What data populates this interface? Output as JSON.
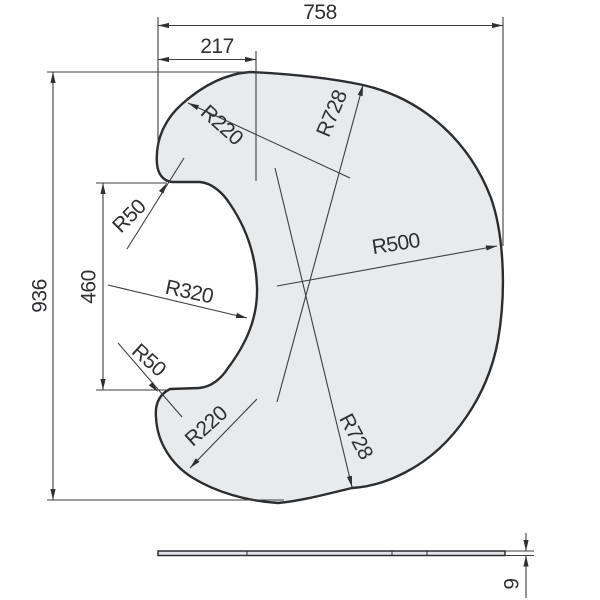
{
  "drawing": {
    "top_view": {
      "width_label": "758",
      "offset_label": "217",
      "height_label": "936",
      "notch_height_label": "460",
      "radius_labels": {
        "top_outer": "R220",
        "top_large": "R728",
        "right": "R500",
        "notch": "R320",
        "notch_top_fillet": "R50",
        "notch_bottom_fillet": "R50",
        "bottom_outer": "R220",
        "bottom_large": "R728"
      }
    },
    "side_view": {
      "thickness_label": "9"
    },
    "colors": {
      "background": "#ffffff",
      "part_fill": "#e9eaec",
      "outline": "#2b2d30",
      "dimension_lines": "#3c3e42",
      "text": "#2e3033"
    }
  }
}
